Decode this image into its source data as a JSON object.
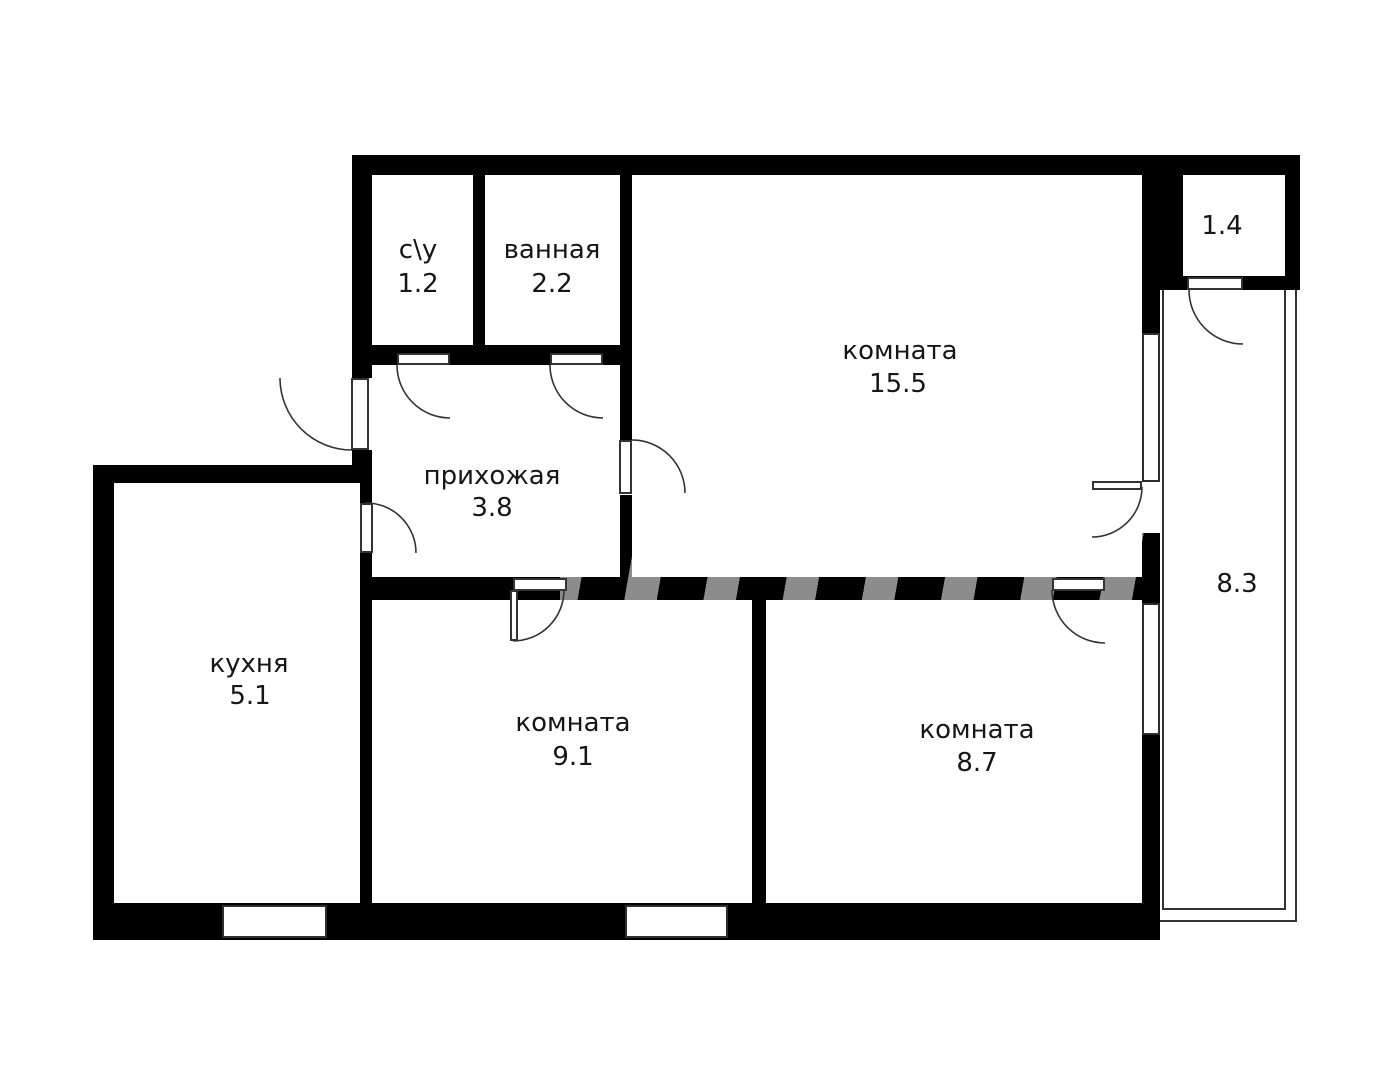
{
  "floorplan": {
    "background_color": "#ffffff",
    "wall_color": "#000000",
    "line_color": "#333333",
    "label_color": "#161616",
    "rooms": {
      "wc": {
        "name": "с\\у",
        "area": "1.2"
      },
      "bathroom": {
        "name": "ванная",
        "area": "2.2"
      },
      "room_main": {
        "name": "комната",
        "area": "15.5"
      },
      "storage": {
        "name": "",
        "area": "1.4"
      },
      "hallway": {
        "name": "прихожая",
        "area": "3.8"
      },
      "kitchen": {
        "name": "кухня",
        "area": "5.1"
      },
      "room_middle": {
        "name": "комната",
        "area": "9.1"
      },
      "room_right": {
        "name": "комната",
        "area": "8.7"
      },
      "balcony": {
        "name": "",
        "area": "8.3"
      }
    }
  }
}
